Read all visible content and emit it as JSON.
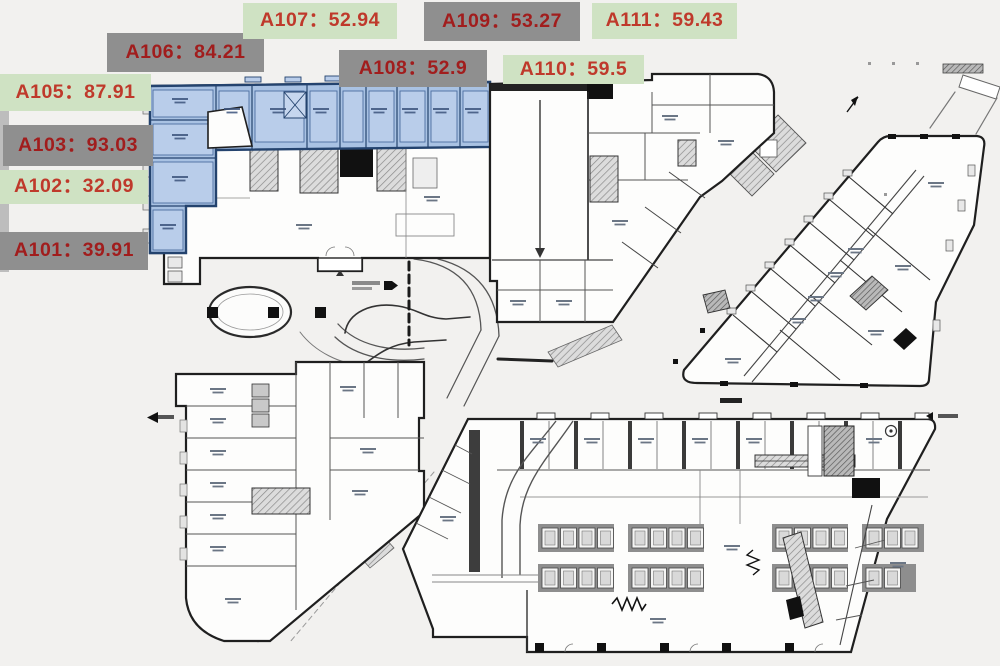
{
  "page": {
    "background": "#f2f1ef",
    "plan_paper": "#fdfdfc",
    "description_labels_count": 10
  },
  "palette": {
    "label_green": "#cfe2c3",
    "label_gray": "#8f8f8f",
    "label_text_on_green": "#bf392b",
    "label_text_on_gray": "#a11d1d",
    "highlight_fill": "#a9c2e3",
    "highlight_inner_fill": "#b9cdea",
    "highlight_wall": "#24436e",
    "wall": "#222222",
    "core_hatch": "#8a8a8a"
  },
  "unit_labels": [
    {
      "id": "A101",
      "area": "39.91",
      "text": "A101：39.91",
      "bg": "gray",
      "x": 0,
      "y": 232,
      "w": 148,
      "h": 38
    },
    {
      "id": "A102",
      "area": "32.09",
      "text": "A102：32.09",
      "bg": "green",
      "x": 0,
      "y": 170,
      "w": 148,
      "h": 34
    },
    {
      "id": "A103",
      "area": "93.03",
      "text": "A103：93.03",
      "bg": "gray",
      "x": 3,
      "y": 125,
      "w": 150,
      "h": 41
    },
    {
      "id": "A105",
      "area": "87.91",
      "text": "A105：87.91",
      "bg": "green",
      "x": 0,
      "y": 74,
      "w": 151,
      "h": 37
    },
    {
      "id": "A106",
      "area": "84.21",
      "text": "A106：84.21",
      "bg": "gray",
      "x": 107,
      "y": 33,
      "w": 157,
      "h": 39
    },
    {
      "id": "A107",
      "area": "52.94",
      "text": "A107：52.94",
      "bg": "green",
      "x": 243,
      "y": 3,
      "w": 154,
      "h": 36
    },
    {
      "id": "A108",
      "area": "52.9",
      "text": "A108：52.9",
      "bg": "gray",
      "x": 339,
      "y": 50,
      "w": 148,
      "h": 37
    },
    {
      "id": "A109",
      "area": "53.27",
      "text": "A109：53.27",
      "bg": "gray",
      "x": 424,
      "y": 2,
      "w": 156,
      "h": 39
    },
    {
      "id": "A110",
      "area": "59.5",
      "text": "A110：59.5",
      "bg": "green",
      "x": 503,
      "y": 55,
      "w": 141,
      "h": 29
    },
    {
      "id": "A111",
      "area": "59.43",
      "text": "A111：59.43",
      "bg": "green",
      "x": 592,
      "y": 3,
      "w": 145,
      "h": 36
    }
  ],
  "highlighted_units": [
    "A101",
    "A102",
    "A103",
    "A105",
    "A106",
    "A107",
    "A108",
    "A109",
    "A110",
    "A111"
  ]
}
